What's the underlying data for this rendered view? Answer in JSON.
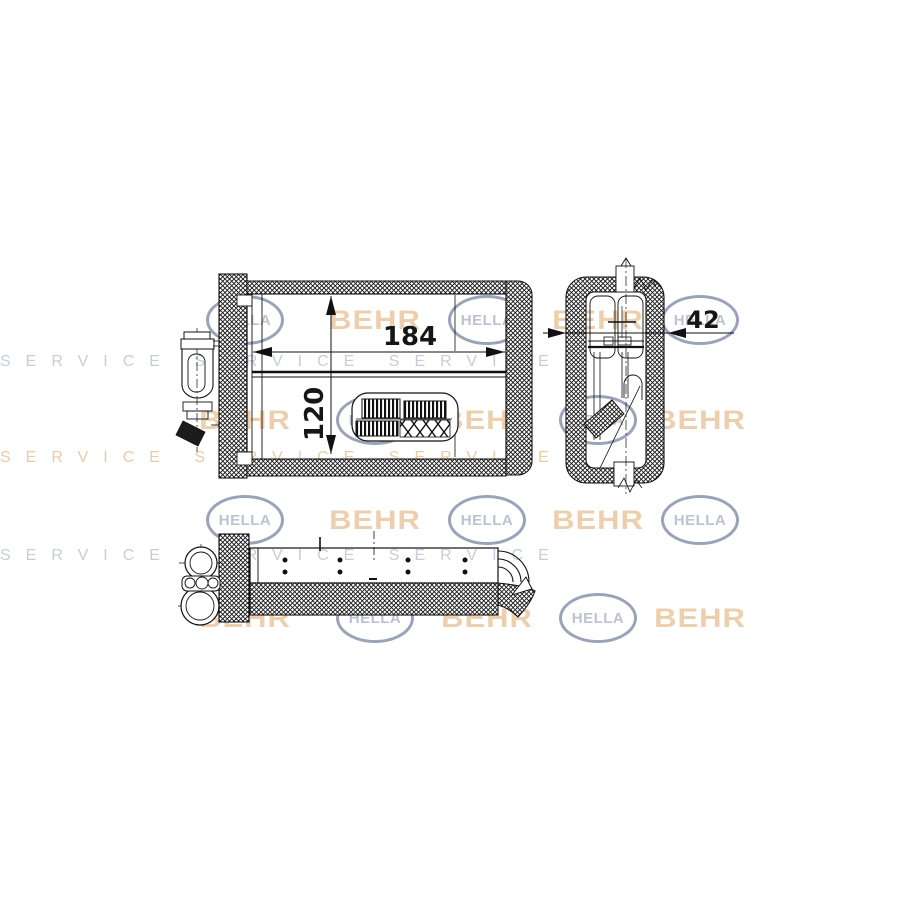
{
  "drawing": {
    "dimensions": {
      "width_mm": "184",
      "height_mm": "120",
      "depth_mm": "42"
    }
  },
  "watermark": {
    "brand_primary": "HELLA",
    "brand_secondary": "BEHR",
    "service_text": "SERVICE",
    "colors": {
      "hella": "#9aa3ba",
      "behr": "#dea05e"
    }
  }
}
